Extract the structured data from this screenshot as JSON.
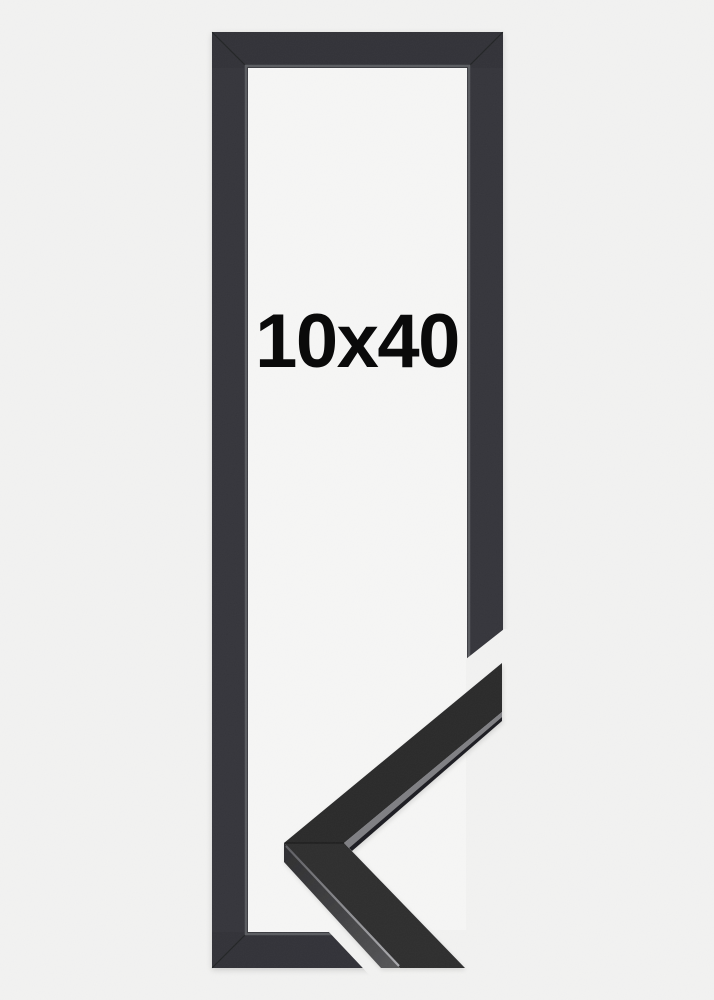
{
  "image": {
    "size_label": "10x40",
    "colors": {
      "background": "#f2f2f1",
      "window": "#f6f6f5",
      "frame": "#34353a",
      "frame_top_bottom_shade": "rgba(0,0,0,0.05)",
      "frame_lip_highlight": "#5a5b61",
      "molding_front_upper": "#29292b",
      "molding_front_lower": "#2d2d2f",
      "molding_side": "#3a3a3c",
      "molding_edge_highlight": "#98989c",
      "molding_rabbet_light": "#7f7f83",
      "molding_rabbet_dark": "#1e1e20",
      "label_text": "#0a0a0a"
    }
  }
}
